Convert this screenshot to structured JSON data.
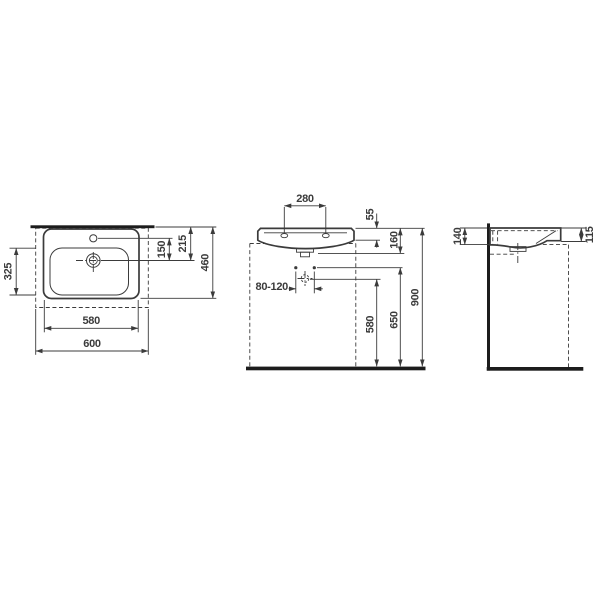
{
  "colors": {
    "ink": "#3b3b3b",
    "heavy": "#1c1c1c",
    "paper": "#ffffff"
  },
  "dims": {
    "top_w580": "580",
    "top_w600": "600",
    "top_d460": "460",
    "top_d215": "215",
    "top_d150": "150",
    "top_d325": "325",
    "front_w280": "280",
    "front_h55": "55",
    "front_h160": "160",
    "front_h580": "580",
    "front_h650": "650",
    "front_h900": "900",
    "front_bolt": "80-120",
    "side_h140": "140",
    "side_h115": "115"
  }
}
